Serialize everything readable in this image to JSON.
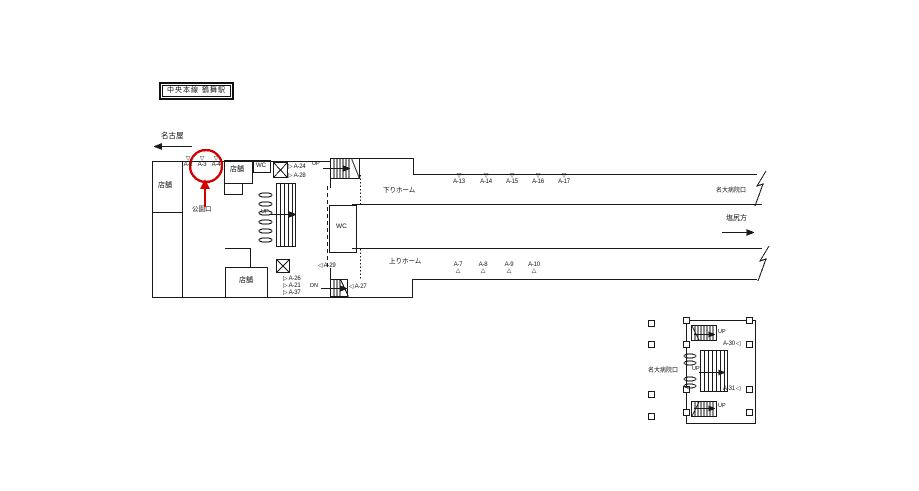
{
  "station": {
    "line_station": "中央本線 鶴舞駅"
  },
  "directions": {
    "left": "名古屋",
    "right": "塩尻方"
  },
  "exits": {
    "park": "公園口",
    "hospital": "名大病院口"
  },
  "platforms": {
    "down": "下りホーム",
    "up": "上りホーム"
  },
  "rooms": {
    "shop": "店舗",
    "wc": "WC"
  },
  "stairs": {
    "up": "UP",
    "down": "DN"
  },
  "markers": {
    "entrance": [
      "A-2",
      "A-3",
      "A-4"
    ],
    "concourse_upper": [
      "A-24",
      "A-28"
    ],
    "concourse_lower": [
      "A-26",
      "A-21",
      "A-37"
    ],
    "stair_west": "A-29",
    "stair_east": "A-27",
    "down_platform": [
      "A-13",
      "A-14",
      "A-15",
      "A-16",
      "A-17"
    ],
    "up_platform": [
      "A-7",
      "A-8",
      "A-9",
      "A-10"
    ],
    "minimap": [
      "A-30",
      "A-31"
    ]
  },
  "highlight": {
    "color": "#d40000"
  }
}
